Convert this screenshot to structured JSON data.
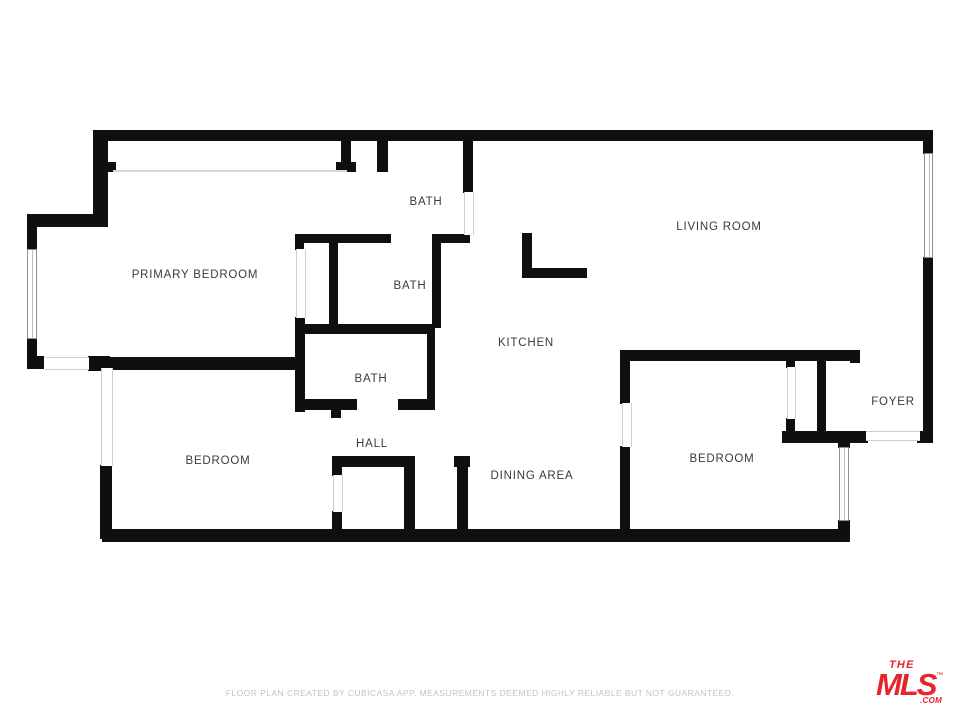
{
  "plan": {
    "wall_color": "#0f0f0f",
    "label_color": "#3a3a3a",
    "rooms": [
      {
        "label": "BATH",
        "x": 426,
        "y": 202
      },
      {
        "label": "LIVING ROOM",
        "x": 719,
        "y": 227
      },
      {
        "label": "PRIMARY BEDROOM",
        "x": 195,
        "y": 275
      },
      {
        "label": "BATH",
        "x": 410,
        "y": 286
      },
      {
        "label": "KITCHEN",
        "x": 526,
        "y": 343
      },
      {
        "label": "BATH",
        "x": 371,
        "y": 379
      },
      {
        "label": "FOYER",
        "x": 893,
        "y": 402
      },
      {
        "label": "HALL",
        "x": 372,
        "y": 444
      },
      {
        "label": "BEDROOM",
        "x": 218,
        "y": 461
      },
      {
        "label": "BEDROOM",
        "x": 722,
        "y": 459
      },
      {
        "label": "DINING AREA",
        "x": 532,
        "y": 476
      }
    ],
    "walls": [
      {
        "x": 93,
        "y": 130,
        "w": 840,
        "h": 11
      },
      {
        "x": 93,
        "y": 130,
        "w": 15,
        "h": 96
      },
      {
        "x": 27,
        "y": 214,
        "w": 81,
        "h": 13
      },
      {
        "x": 27,
        "y": 214,
        "w": 10,
        "h": 36
      },
      {
        "x": 27,
        "y": 338,
        "w": 10,
        "h": 31
      },
      {
        "x": 27,
        "y": 356,
        "w": 17,
        "h": 13
      },
      {
        "x": 88,
        "y": 356,
        "w": 22,
        "h": 15
      },
      {
        "x": 100,
        "y": 465,
        "w": 12,
        "h": 74
      },
      {
        "x": 102,
        "y": 529,
        "w": 748,
        "h": 13
      },
      {
        "x": 838,
        "y": 520,
        "w": 12,
        "h": 13
      },
      {
        "x": 838,
        "y": 437,
        "w": 12,
        "h": 11
      },
      {
        "x": 782,
        "y": 431,
        "w": 86,
        "h": 12
      },
      {
        "x": 923,
        "y": 140,
        "w": 10,
        "h": 14
      },
      {
        "x": 923,
        "y": 257,
        "w": 10,
        "h": 186
      },
      {
        "x": 917,
        "y": 431,
        "w": 16,
        "h": 12
      },
      {
        "x": 108,
        "y": 162,
        "w": 8,
        "h": 10
      },
      {
        "x": 341,
        "y": 140,
        "w": 10,
        "h": 26
      },
      {
        "x": 336,
        "y": 162,
        "w": 20,
        "h": 10
      },
      {
        "x": 377,
        "y": 140,
        "w": 11,
        "h": 32
      },
      {
        "x": 463,
        "y": 140,
        "w": 10,
        "h": 53
      },
      {
        "x": 432,
        "y": 234,
        "w": 38,
        "h": 9
      },
      {
        "x": 432,
        "y": 234,
        "w": 9,
        "h": 94
      },
      {
        "x": 295,
        "y": 234,
        "w": 96,
        "h": 9
      },
      {
        "x": 295,
        "y": 234,
        "w": 9,
        "h": 16
      },
      {
        "x": 329,
        "y": 240,
        "w": 9,
        "h": 86
      },
      {
        "x": 295,
        "y": 317,
        "w": 10,
        "h": 95
      },
      {
        "x": 295,
        "y": 324,
        "w": 140,
        "h": 10
      },
      {
        "x": 427,
        "y": 326,
        "w": 8,
        "h": 84
      },
      {
        "x": 296,
        "y": 399,
        "w": 61,
        "h": 11
      },
      {
        "x": 331,
        "y": 405,
        "w": 10,
        "h": 13
      },
      {
        "x": 398,
        "y": 399,
        "w": 37,
        "h": 11
      },
      {
        "x": 108,
        "y": 357,
        "w": 190,
        "h": 13
      },
      {
        "x": 332,
        "y": 456,
        "w": 10,
        "h": 20
      },
      {
        "x": 332,
        "y": 511,
        "w": 10,
        "h": 20
      },
      {
        "x": 332,
        "y": 456,
        "w": 81,
        "h": 11
      },
      {
        "x": 404,
        "y": 456,
        "w": 11,
        "h": 76
      },
      {
        "x": 454,
        "y": 456,
        "w": 16,
        "h": 11
      },
      {
        "x": 457,
        "y": 456,
        "w": 11,
        "h": 76
      },
      {
        "x": 522,
        "y": 233,
        "w": 10,
        "h": 45
      },
      {
        "x": 522,
        "y": 268,
        "w": 65,
        "h": 10
      },
      {
        "x": 620,
        "y": 350,
        "w": 240,
        "h": 11
      },
      {
        "x": 620,
        "y": 350,
        "w": 10,
        "h": 54
      },
      {
        "x": 620,
        "y": 446,
        "w": 10,
        "h": 86
      },
      {
        "x": 850,
        "y": 350,
        "w": 10,
        "h": 13
      },
      {
        "x": 786,
        "y": 360,
        "w": 9,
        "h": 8
      },
      {
        "x": 786,
        "y": 418,
        "w": 9,
        "h": 15
      },
      {
        "x": 817,
        "y": 350,
        "w": 9,
        "h": 90
      }
    ],
    "windows": [
      {
        "x": 27,
        "y": 249,
        "w": 10,
        "h": 90,
        "orient": "v"
      },
      {
        "x": 839,
        "y": 447,
        "w": 10,
        "h": 74,
        "orient": "v"
      },
      {
        "x": 924,
        "y": 153,
        "w": 9,
        "h": 105,
        "orient": "v"
      }
    ],
    "openings": [
      {
        "x": 45,
        "y": 357,
        "w": 44,
        "h": 11,
        "orient": "h"
      },
      {
        "x": 101,
        "y": 368,
        "w": 10,
        "h": 98,
        "orient": "v"
      },
      {
        "x": 464,
        "y": 192,
        "w": 8,
        "h": 43,
        "orient": "v"
      },
      {
        "x": 296,
        "y": 249,
        "w": 8,
        "h": 69,
        "orient": "v"
      },
      {
        "x": 866,
        "y": 431,
        "w": 54,
        "h": 8,
        "orient": "h"
      },
      {
        "x": 622,
        "y": 403,
        "w": 8,
        "h": 44,
        "orient": "v"
      },
      {
        "x": 787,
        "y": 367,
        "w": 7,
        "h": 52,
        "orient": "v"
      },
      {
        "x": 333,
        "y": 475,
        "w": 8,
        "h": 37,
        "orient": "v"
      }
    ],
    "closet_lines": [
      {
        "x": 113,
        "y": 170,
        "w": 234
      }
    ]
  },
  "footer": {
    "disclaimer": "FLOOR PLAN CREATED BY CUBICASA APP. MEASUREMENTS DEEMED HIGHLY RELIABLE BUT NOT GUARANTEED."
  },
  "logo": {
    "the": "THE",
    "mls": "MLS",
    "tm": "™",
    "com": ".COM",
    "color": "#e6242b"
  }
}
